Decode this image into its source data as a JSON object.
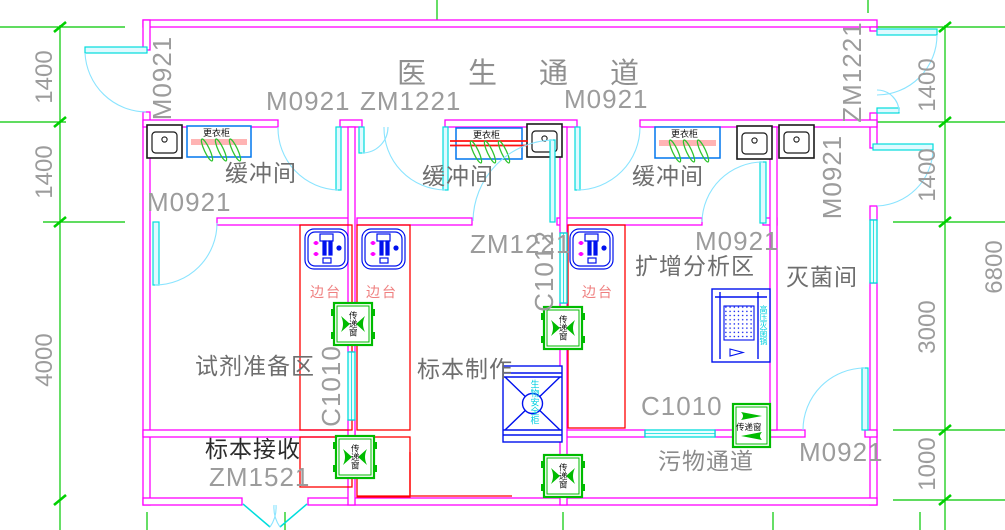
{
  "plan": {
    "corridors": {
      "doctor": "医生通道",
      "waste": "污物通道"
    },
    "rooms": {
      "buffer1": "缓冲间",
      "buffer2": "缓冲间",
      "buffer3": "缓冲间",
      "reagent_prep": "试剂准备区",
      "specimen_making": "标本制作",
      "amplification": "扩增分析区",
      "sterilization": "灭菌间",
      "specimen_receiving": "标本接收"
    },
    "door_codes": {
      "left_exit": "M0921",
      "buffer1_top": "M0921",
      "buffer2_top": "ZM1221",
      "buffer3_top": "M0921",
      "right_exit_top": "ZM1221",
      "right_exit_mid": "M0921",
      "buffer1_bottom": "M0921",
      "buffer2_bottom": "ZM1221",
      "buffer3_bottom": "M0921",
      "sterilization_bottom": "M0921",
      "receiving_bottom": "ZM1521"
    },
    "window_codes": {
      "reagent_specimen_wall": "C1010",
      "specimen_amplification_wall": "C1012",
      "waste_corridor_wall": "C1010"
    },
    "fixtures": {
      "wardrobe": "更衣柜",
      "bench": "边台",
      "pass_window": "传递窗",
      "biosafety_cabinet": "生物安全柜",
      "autoclave": "高压灭菌锅"
    },
    "dimensions": {
      "left": [
        "1400",
        "1400",
        "4000"
      ],
      "right": [
        "1400",
        "1400",
        "3000",
        "1000"
      ],
      "overall": "6800"
    },
    "colors": {
      "wall": "#ff00ff",
      "door_window": "#00e5ee",
      "dimension": "#00c800",
      "bench": "#ff0000",
      "equipment": "#0011ee",
      "label_gray": "#9c9c9c"
    }
  }
}
